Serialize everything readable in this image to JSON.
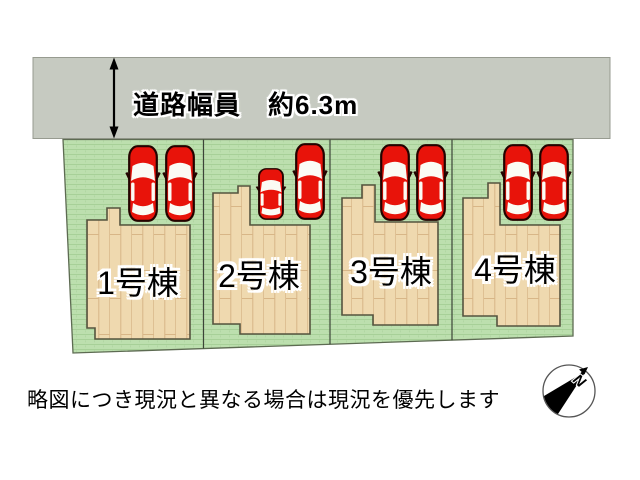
{
  "road": {
    "width_label": "道路幅員　約6.3m"
  },
  "lots": [
    {
      "label": "1号棟",
      "cars": 2
    },
    {
      "label": "2号棟",
      "cars": 2
    },
    {
      "label": "3号棟",
      "cars": 2
    },
    {
      "label": "4号棟",
      "cars": 2
    }
  ],
  "disclaimer": "略図につき現況と異なる場合は現況を優先します",
  "compass": {
    "north_label": "N"
  },
  "colors": {
    "road": "#c6cac1",
    "grass": "#bcdfae",
    "grass_line": "#a5cf96",
    "building": "#efd9af",
    "building_plank_line": "#d8b687",
    "building_outline": "#55543f",
    "car_red": "#e8130a",
    "car_outline": "#230300",
    "boundary_line": "#3c4438"
  }
}
